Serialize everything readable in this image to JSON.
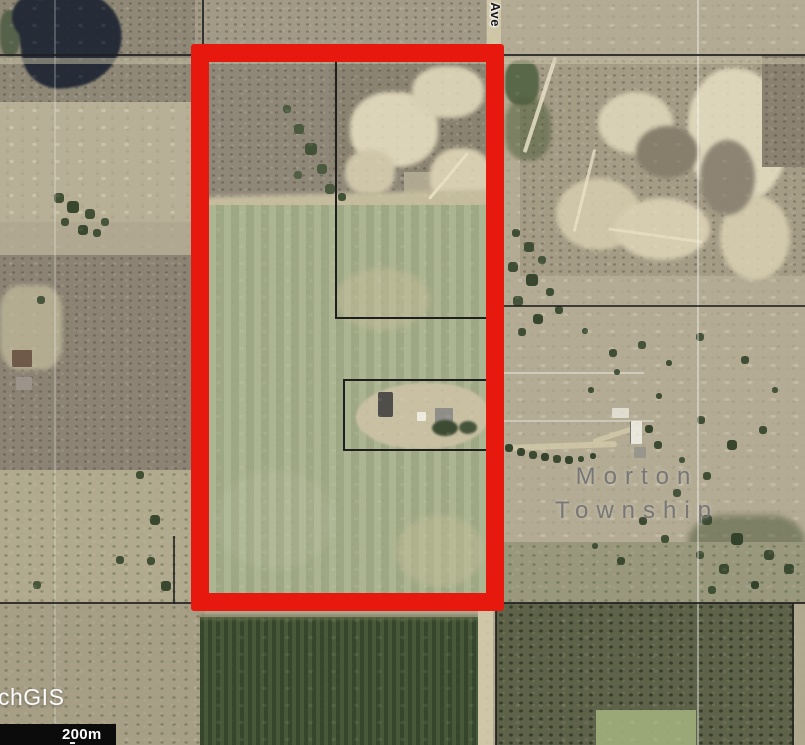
{
  "map": {
    "road_label": "n Ave",
    "township": {
      "line1": "Morton",
      "line2": "Township"
    },
    "watermark": "chGIS",
    "scale": {
      "label": "200m"
    },
    "colors": {
      "highlight": "#e7190f",
      "boundary": "#1f1f1f"
    }
  }
}
